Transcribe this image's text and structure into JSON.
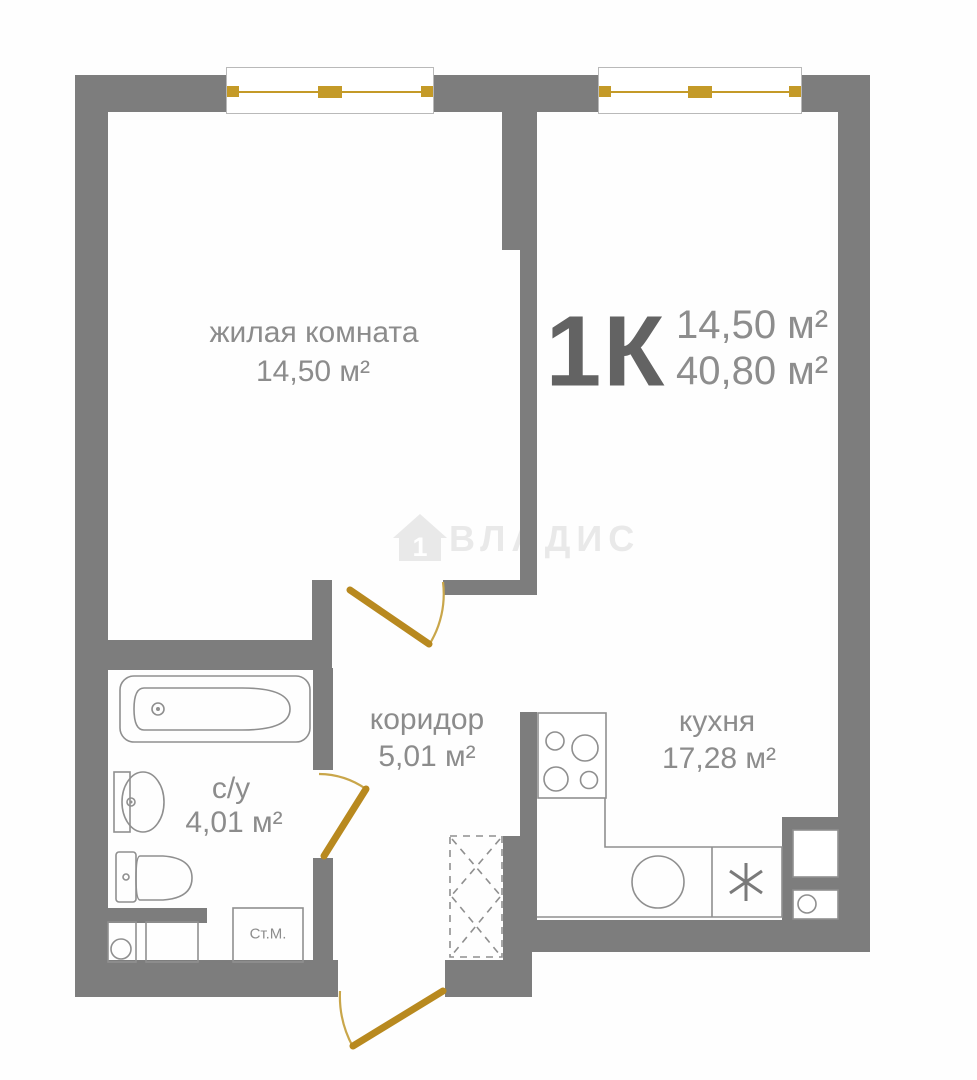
{
  "apartment": {
    "type": "1К",
    "room_area": "14,50 м²",
    "total_area": "40,80 м²"
  },
  "rooms": {
    "living": {
      "label": "жилая комната",
      "area": "14,50 м²"
    },
    "corridor": {
      "label": "коридор",
      "area": "5,01 м²"
    },
    "kitchen": {
      "label": "кухня",
      "area": "17,28 м²"
    },
    "bathroom": {
      "label": "с/у",
      "area": "4,01 м²"
    }
  },
  "fixtures": {
    "washing_machine_label": "Ст.М."
  },
  "watermark": {
    "text": "ВЛАДИС",
    "house_number": "1"
  },
  "colors": {
    "wall": "#7d7d7d",
    "door": "#b8891f",
    "door_arc": "#c9a64a",
    "fixture": "#8f8f8f",
    "label": "#8c8c8c",
    "label_dark": "#636363",
    "watermark": "#e9e9e9",
    "window_accent": "#c49a28"
  }
}
